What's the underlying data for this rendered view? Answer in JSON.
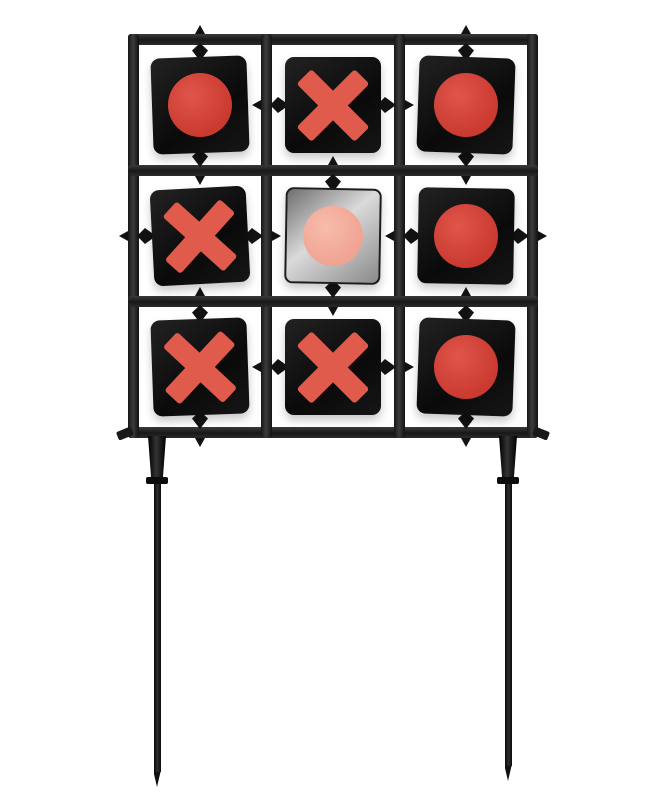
{
  "scene": {
    "type": "product-photo",
    "subject": "spinning tic-tac-toe shooting target on ground stakes",
    "background": "#ffffff"
  },
  "colors": {
    "background": "#ffffff",
    "frame": "#232323",
    "spindle": "#121212",
    "panel_black": "#0e0e0e",
    "panel_silver": "#b5b5b5",
    "circle_red": "#ca3a30",
    "circle_red_hi": "#e0554a",
    "cross_red": "#e05b4c",
    "circle_pink": "#f0a393",
    "circle_pink_hi": "#f7bcab",
    "leg_black": "#141414"
  },
  "target": {
    "rows": 3,
    "cols": 3,
    "cells": [
      {
        "row": 0,
        "col": 0,
        "symbol": "circle",
        "axis": "vertical",
        "panel": "black",
        "rotation": -2
      },
      {
        "row": 0,
        "col": 1,
        "symbol": "cross",
        "axis": "horizontal",
        "panel": "black",
        "rotation": 0
      },
      {
        "row": 0,
        "col": 2,
        "symbol": "circle",
        "axis": "vertical",
        "panel": "black",
        "rotation": 2
      },
      {
        "row": 1,
        "col": 0,
        "symbol": "cross",
        "axis": "horizontal",
        "panel": "black",
        "rotation": -3
      },
      {
        "row": 1,
        "col": 1,
        "symbol": "circle",
        "axis": "vertical",
        "panel": "silver",
        "rotation": 1
      },
      {
        "row": 1,
        "col": 2,
        "symbol": "circle",
        "axis": "horizontal",
        "panel": "black",
        "rotation": 1
      },
      {
        "row": 2,
        "col": 0,
        "symbol": "cross",
        "axis": "vertical",
        "panel": "black",
        "rotation": -2
      },
      {
        "row": 2,
        "col": 1,
        "symbol": "cross",
        "axis": "horizontal",
        "panel": "black",
        "rotation": 0
      },
      {
        "row": 2,
        "col": 2,
        "symbol": "circle",
        "axis": "vertical",
        "panel": "black",
        "rotation": 2
      }
    ],
    "symbol_counts": {
      "circle": 5,
      "cross": 4
    }
  },
  "legs": {
    "count": 2,
    "style": "pointed ground stakes"
  }
}
